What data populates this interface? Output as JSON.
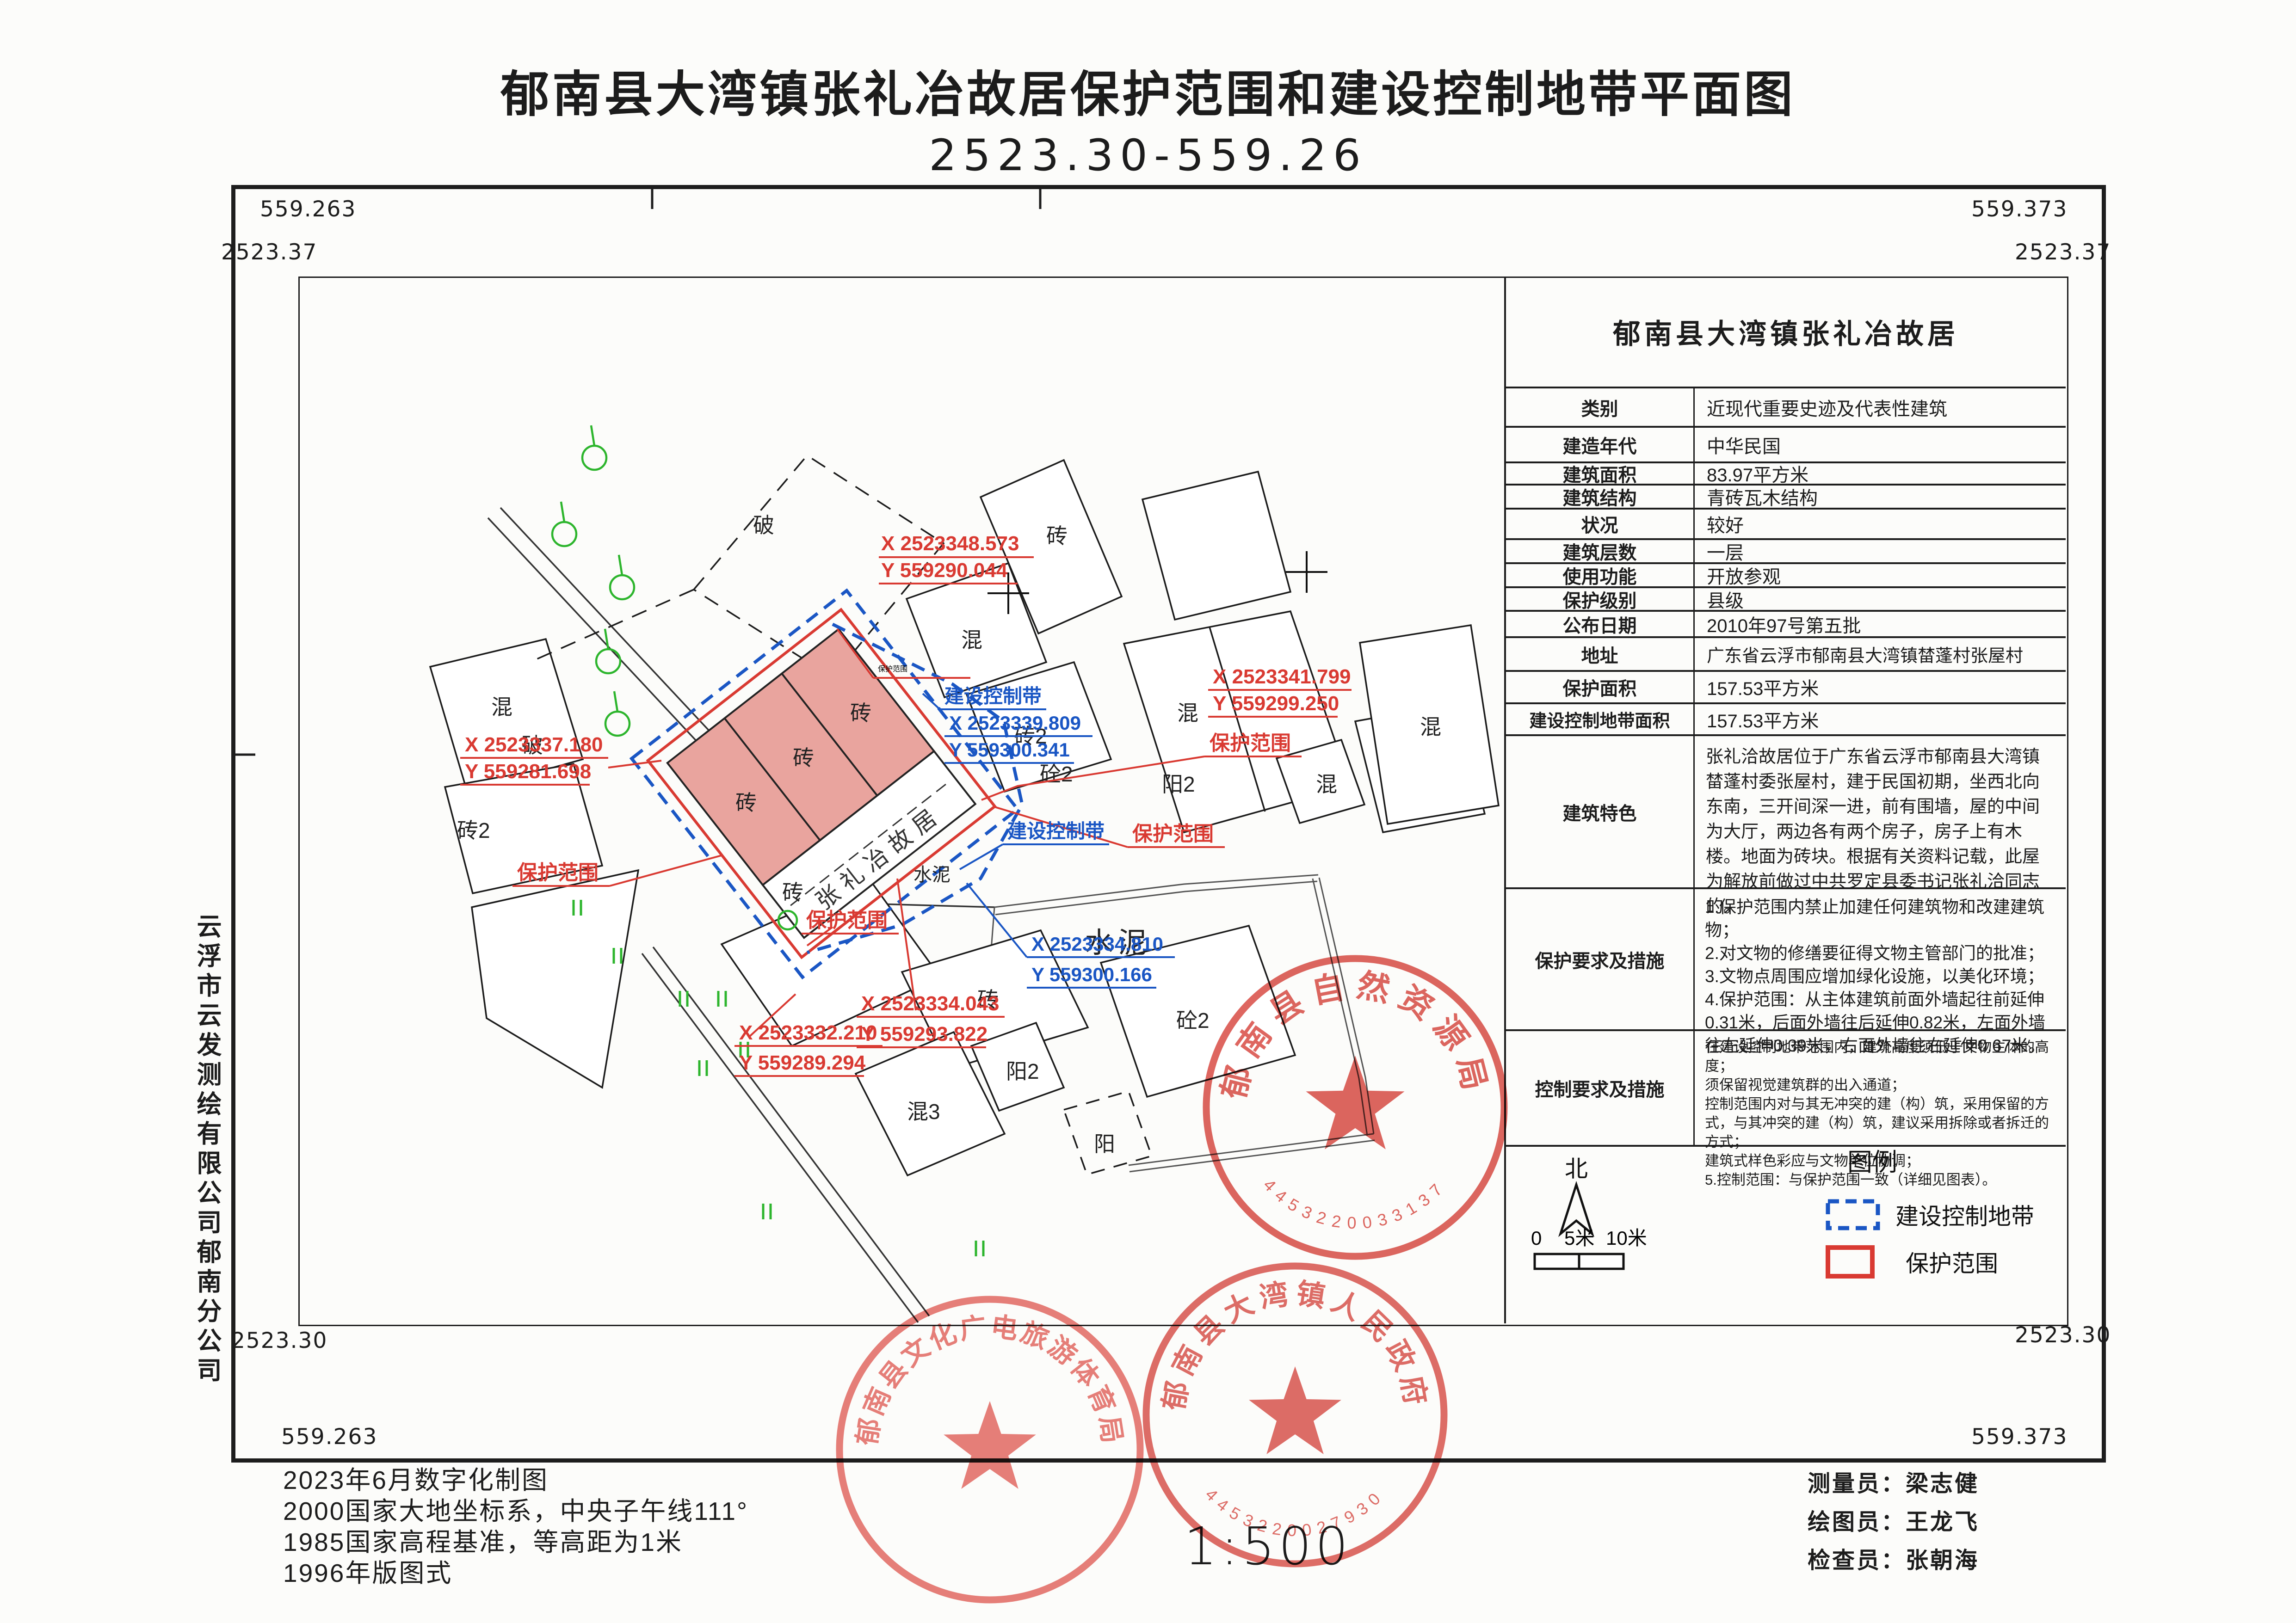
{
  "title": "郁南县大湾镇张礼冶故居保护范围和建设控制地带平面图",
  "subtitle": "2523.30-559.26",
  "scale": "1:500",
  "frame_coords": {
    "top_left": {
      "y": "559.263",
      "x": "2523.37"
    },
    "top_right": {
      "y": "559.373",
      "x": "2523.37"
    },
    "bottom_left": {
      "x": "2523.30",
      "y": "559.263"
    },
    "bottom_right": {
      "x": "2523.30",
      "y": "559.373"
    }
  },
  "sidebar": {
    "company": "云浮市云发测绘有限公司郁南分公司"
  },
  "notes": [
    "2023年6月数字化制图",
    "2000国家大地坐标系，中央子午线111°",
    "1985国家高程基准，等高距为1米",
    "1996年版图式"
  ],
  "credits": [
    "测量员：梁志健",
    "绘图员：王龙飞",
    "检查员：张朝海"
  ],
  "info_table": {
    "title": "郁南县大湾镇张礼冶故居",
    "rows": [
      {
        "label": "类别",
        "value": "近现代重要史迹及代表性建筑"
      },
      {
        "label": "建造年代",
        "value": "中华民国"
      },
      {
        "label": "建筑面积",
        "value": "83.97平方米"
      },
      {
        "label": "建筑结构",
        "value": "青砖瓦木结构"
      },
      {
        "label": "状况",
        "value": "较好"
      },
      {
        "label": "建筑层数",
        "value": "一层"
      },
      {
        "label": "使用功能",
        "value": "开放参观"
      },
      {
        "label": "保护级别",
        "value": "县级"
      },
      {
        "label": "公布日期",
        "value": "2010年97号第五批"
      },
      {
        "label": "地址",
        "value": "广东省云浮市郁南县大湾镇榃蓬村张屋村"
      },
      {
        "label": "保护面积",
        "value": "157.53平方米"
      },
      {
        "label": "建设控制地带面积",
        "value": "157.53平方米"
      }
    ],
    "features": {
      "label": "建筑特色",
      "text": "张礼洽故居位于广东省云浮市郁南县大湾镇榃蓬村委张屋村，建于民国初期，坐西北向东南，三开间深一进，前有围墙，屋的中间为大厅，两边各有两个房子，房子上有木楼。地面为砖块。根据有关资料记载，此屋为解放前做过中共罗定县委书记张礼洽同志的。"
    },
    "protection": {
      "label": "保护要求及措施",
      "lines": [
        "1.保护范围内禁止加建任何建筑物和改建建筑物；",
        "2.对文物的修缮要征得文物主管部门的批准；",
        "3.文物点周围应增加绿化设施，以美化环境；",
        "4.保护范围：从主体建筑前面外墙起往前延伸0.31米，后面外墙往后延伸0.82米，左面外墙往左延伸0.39米，右面外墙往右延伸0.67米。"
      ]
    },
    "control": {
      "label": "控制要求及措施",
      "lines": [
        "在建设控制地带范围内，建筑高度须低于文物主体的高度；",
        "须保留视觉建筑群的出入通道；",
        "控制范围内对与其无冲突的建（构）筑，采用保留的方式，与其冲突的建（构）筑，建议采用拆除或者拆迁的方式；",
        "建筑式样色彩应与文物单位协调；",
        "5.控制范围：与保护范围一致（详细见图表）。"
      ]
    }
  },
  "legend": {
    "north_label": "北",
    "title": "图例",
    "scale_ticks": [
      "0",
      "5米",
      "10米"
    ],
    "items": [
      {
        "label": "建设控制地带"
      },
      {
        "label": "保护范围"
      }
    ]
  },
  "map": {
    "building_name": "张礼冶故居",
    "material_labels": [
      {
        "t": "破"
      },
      {
        "t": "砖"
      },
      {
        "t": "混"
      },
      {
        "t": "砖2"
      },
      {
        "t": "砼2"
      },
      {
        "t": "混"
      },
      {
        "t": "阳2"
      },
      {
        "t": "混"
      },
      {
        "t": "混"
      },
      {
        "t": "破"
      },
      {
        "t": "混"
      },
      {
        "t": "砖2"
      },
      {
        "t": "水泥"
      },
      {
        "t": "水泥"
      },
      {
        "t": "砖"
      },
      {
        "t": "砖"
      },
      {
        "t": "砖"
      },
      {
        "t": "砖"
      },
      {
        "t": "砖"
      },
      {
        "t": "砼2"
      },
      {
        "t": "混3"
      },
      {
        "t": "阳2"
      },
      {
        "t": "阳"
      }
    ],
    "red_points": [
      {
        "x": "X 2523348.573",
        "y": "Y 559290.044",
        "name": "保护范围"
      },
      {
        "x": "X 2523341.799",
        "y": "Y 559299.250",
        "name": "保护范围"
      },
      {
        "x": "X 2523337.180",
        "y": "Y 559281.698",
        "name": "保护范围"
      },
      {
        "x": "X 2523332.210",
        "y": "Y 559289.294",
        "name": "保护范围"
      },
      {
        "x": "X 2523334.043",
        "y": "Y 559293.822",
        "name": "保护范围"
      }
    ],
    "blue_points": [
      {
        "name": "建设控制带",
        "x": "X 2523339.809",
        "y": "Y 559300.341"
      },
      {
        "name": "建设控制带",
        "x": "X 2523334.810",
        "y": "Y 559300.166"
      }
    ]
  },
  "stamps": [
    {
      "text": "郁南县自然资源局",
      "number": "4453220033137"
    },
    {
      "text": "郁南县文化广电旅游体育局",
      "number": ""
    },
    {
      "text": "郁南县大湾镇人民政府",
      "number": "4453220027930"
    }
  ],
  "colors": {
    "protection": "#d93a32",
    "control_zone": "#1a56c4",
    "building_fill": "#e9a49e",
    "stamp": "#d7453e",
    "tree": "#2db52d"
  }
}
